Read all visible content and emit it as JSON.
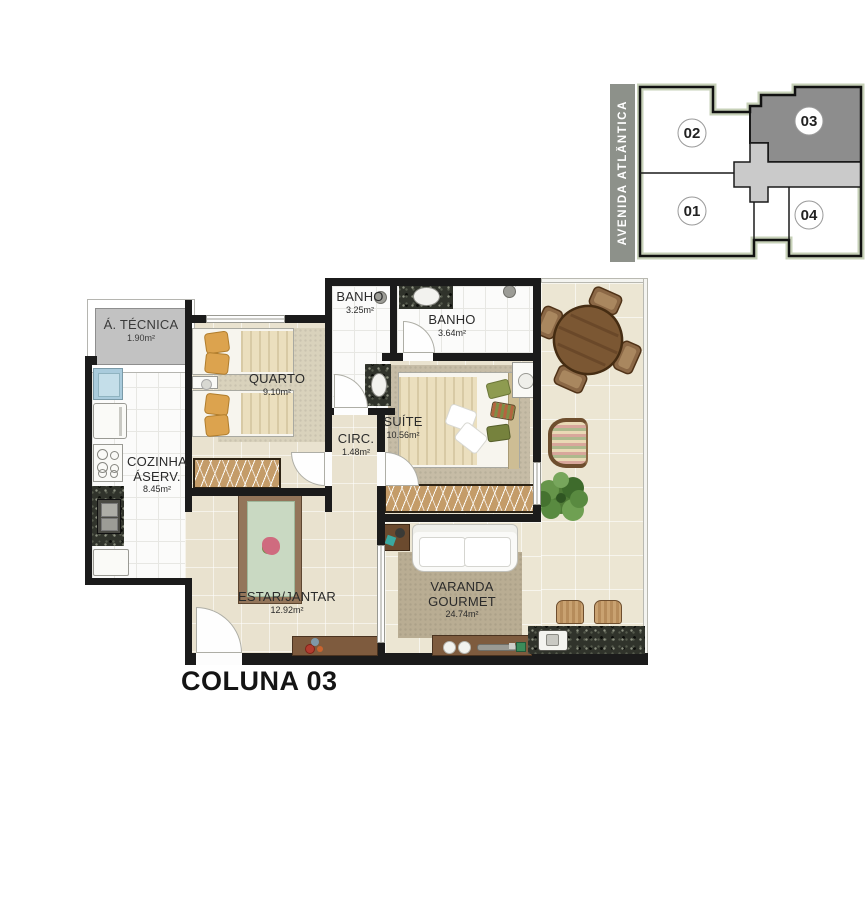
{
  "title": "COLUNA 03",
  "key_plan": {
    "street_label": "AVENIDA  ATLÂNTICA",
    "highlighted_unit": "03",
    "units": [
      {
        "number": "02",
        "highlighted": false
      },
      {
        "number": "03",
        "highlighted": true
      },
      {
        "number": "01",
        "highlighted": false
      },
      {
        "number": "04",
        "highlighted": false
      }
    ]
  },
  "rooms": [
    {
      "name": "Á. TÉCNICA",
      "area": "1.90m²"
    },
    {
      "name": "COZINHA",
      "name2": "ÁSERV.",
      "area": "8.45m²"
    },
    {
      "name": "QUARTO",
      "area": "9.10m²"
    },
    {
      "name": "BANHO",
      "area": "3.25m²"
    },
    {
      "name": "BANHO",
      "area": "3.64m²"
    },
    {
      "name": "SUÍTE",
      "area": "10.56m²"
    },
    {
      "name": "CIRC.",
      "area": "1.48m²"
    },
    {
      "name": "ESTAR/JANTAR",
      "area": "12.92m²"
    },
    {
      "name": "VARANDA",
      "name2": "GOURMET",
      "area": "24.74m²"
    }
  ],
  "colors": {
    "wall": "#1B1B1B",
    "floor_beige": "#E9E2CF",
    "floor_tile": "#FBFBFA",
    "wood_wardrobe": "#C49C69",
    "wood_dark": "#7E5B3E",
    "keyplan_highlight": "#8D8D8D",
    "keyplan_corridor": "#CACACA",
    "keyplan_border_green": "#C7D1B8",
    "street_bar": "#8D918A"
  }
}
